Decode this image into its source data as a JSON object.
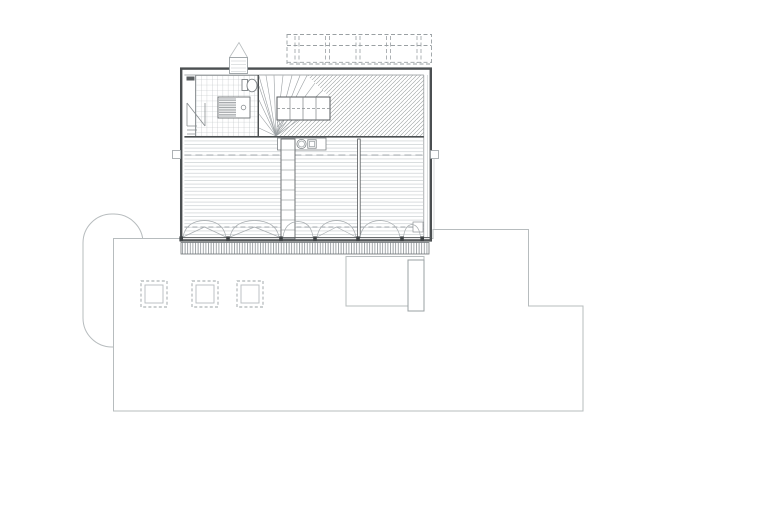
{
  "document": {
    "title": "Architectural floor plan — attic level with roof terrace and site outline",
    "drawing_type": "technical line drawing, no text labels"
  },
  "palette": {
    "paper": "#ffffff",
    "wall": "#4b4f51",
    "detail": "#7d8285",
    "site": "#b7bcbe",
    "dash": "#9aa0a3",
    "hatch": "#9aa0a0",
    "floor": "#cbd0d2",
    "post": "#3f4345"
  },
  "plan": {
    "level": "attic",
    "rooms": [
      {
        "name": "bathroom",
        "finish": "tile grid"
      },
      {
        "name": "stair-hall",
        "finish": "diagonal hatch"
      },
      {
        "name": "main-room",
        "finish": "plank flooring"
      }
    ],
    "fixtures": [
      "shower",
      "toilet",
      "bathroom-door",
      "winder-stair",
      "stair-flight-box",
      "kitchen-counter",
      "sink",
      "cooktop",
      "shelf-column",
      "room-divider"
    ],
    "site_elements": [
      "driveway-loop",
      "ground-floor-outline",
      "lower-patio",
      "chimney-shaft",
      "roof-pergola-dashed",
      "terrace-edge-hatch",
      "roof-vent",
      "section-markers"
    ],
    "skylight_count": 3,
    "window_bay_count": 6
  }
}
